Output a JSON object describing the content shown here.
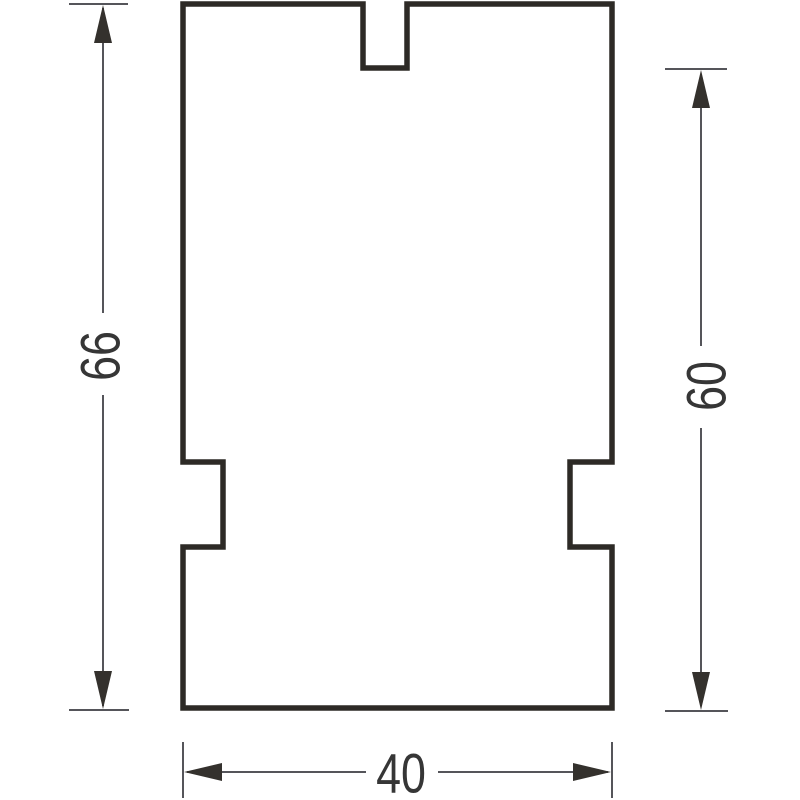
{
  "drawing": {
    "canvas": {
      "width": 800,
      "height": 800,
      "background": "#ffffff"
    },
    "colors": {
      "outline": "#2d2a26",
      "dimension_line": "#55555a",
      "arrow": "#34312d",
      "text": "#363636"
    },
    "profile": {
      "description": "rectangular profile with top center groove and two side notches",
      "path": "M 183 4 L 363 4 L 363 68 L 407 68 L 407 4 L 612 4 L 612 462 L 570 462 L 570 547 L 612 547 L 612 708 L 183 708 L 183 547 L 223 547 L 223 462 L 183 462 Z",
      "stroke_width": 5.5
    },
    "dimensions": {
      "left_total_height": {
        "label": "66",
        "orientation": "vertical"
      },
      "right_height": {
        "label": "60",
        "orientation": "vertical"
      },
      "bottom_width": {
        "label": "40",
        "orientation": "horizontal"
      }
    }
  }
}
